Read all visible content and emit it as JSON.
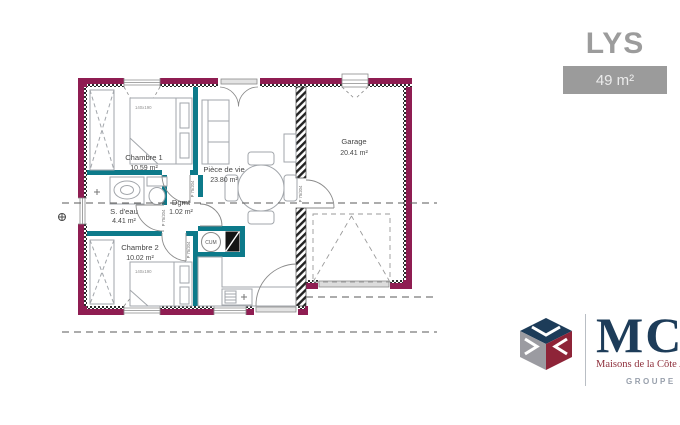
{
  "header": {
    "model_name": "LYS",
    "area_badge": "49 m²"
  },
  "plan": {
    "rooms": {
      "chambre1": {
        "name": "Chambre 1",
        "area": "10.59 m²"
      },
      "sdeau": {
        "name": "S. d'eau",
        "area": "4.41 m²"
      },
      "chambre2": {
        "name": "Chambre 2",
        "area": "10.02 m²"
      },
      "degagement": {
        "name": "Dgmt",
        "area": "1.02 m²"
      },
      "piece_de_vie": {
        "name": "Pièce de vie",
        "area": "23.80 m²"
      },
      "garage": {
        "name": "Garage",
        "area": "20.41 m²"
      }
    },
    "annotations": {
      "water_heater": "CUM",
      "bed_size": "140x190",
      "door_size": "P 75/204"
    },
    "colors": {
      "exterior_wall": "#8f1d52",
      "interior_wall": "#0d7a8a",
      "furniture_line": "#a2a6ab"
    }
  },
  "branding": {
    "logo_text": "MCA",
    "logo_subtitle": "Maisons de la Côte Atlantique",
    "logo_group": "GROUPE HEXAOM",
    "colors": {
      "navy": "#1d3c59",
      "maroon": "#8e2438",
      "gray": "#9b9ba1"
    }
  }
}
